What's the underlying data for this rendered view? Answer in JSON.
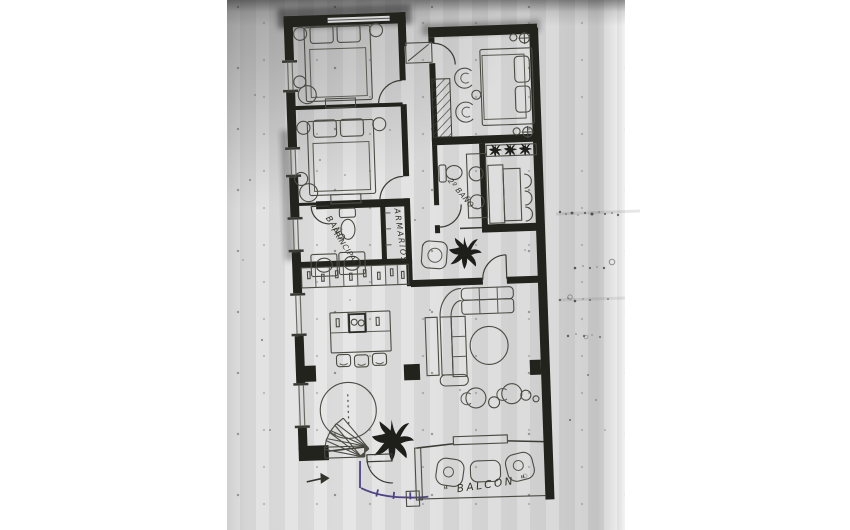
{
  "palette": {
    "background": "#ffffff",
    "paper": "#dcdcdc",
    "wall_ink": "#23231e",
    "furniture_ink": "#4c4c45",
    "label_ink": "#33332c",
    "accent_ink": "#4f4286"
  },
  "plan": {
    "labels": {
      "master_bath_line1": "BAÑO",
      "master_bath_line2": "PRINCIPAL",
      "wardrobe": "ARMARIOS",
      "second_bath": "2º BAÑO",
      "balcony": "\" BALCON \""
    }
  }
}
